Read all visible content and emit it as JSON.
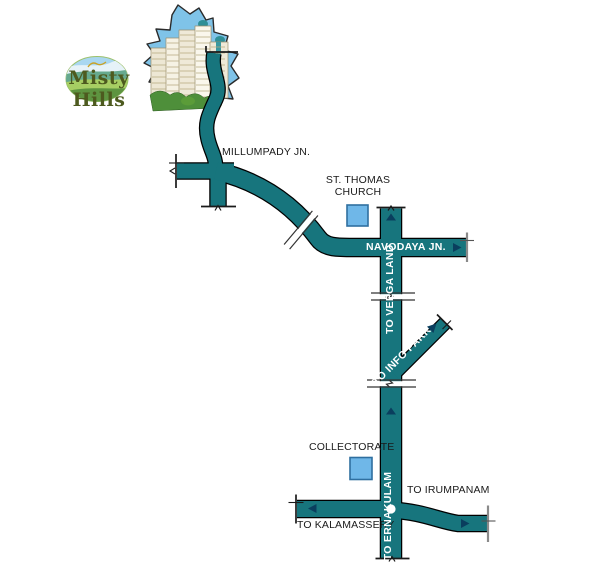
{
  "page": {
    "width": 600,
    "height": 576,
    "background": "#FFFFFF"
  },
  "logo": {
    "text": "Misty Hills"
  },
  "map": {
    "labels": {
      "millumpady": "MILLUMPADY JN.",
      "st_thomas_line1": "ST. THOMAS",
      "st_thomas_line2": "CHURCH",
      "navodaya": "NAVODAYA JN.",
      "veega_land": "TO VEEGA LAND",
      "info_park": "TO INFO PARK",
      "collectorate": "COLLECTORATE",
      "irumpanam": "TO IRUMPANAM",
      "kalamassery": "TO KALAMASSERY",
      "ernakulam": "TO ERNAKULAM"
    },
    "landmarks": [
      {
        "name": "st-thomas-church",
        "marker": "blue-square"
      },
      {
        "name": "collectorate",
        "marker": "blue-square"
      },
      {
        "name": "misty-hills-site",
        "marker": "buildings-illustration"
      }
    ],
    "colors": {
      "road": "#17757D",
      "road_outline": "#000000",
      "landmark_fill": "#6FB7E8",
      "landmark_border": "#2F6FA0",
      "arrow": "#0A3E5E",
      "label_dark": "#1A1A1A",
      "label_light": "#FFFFFF",
      "logo_text": "#4D5A1F",
      "building_sky": "#7FC3E8"
    }
  }
}
